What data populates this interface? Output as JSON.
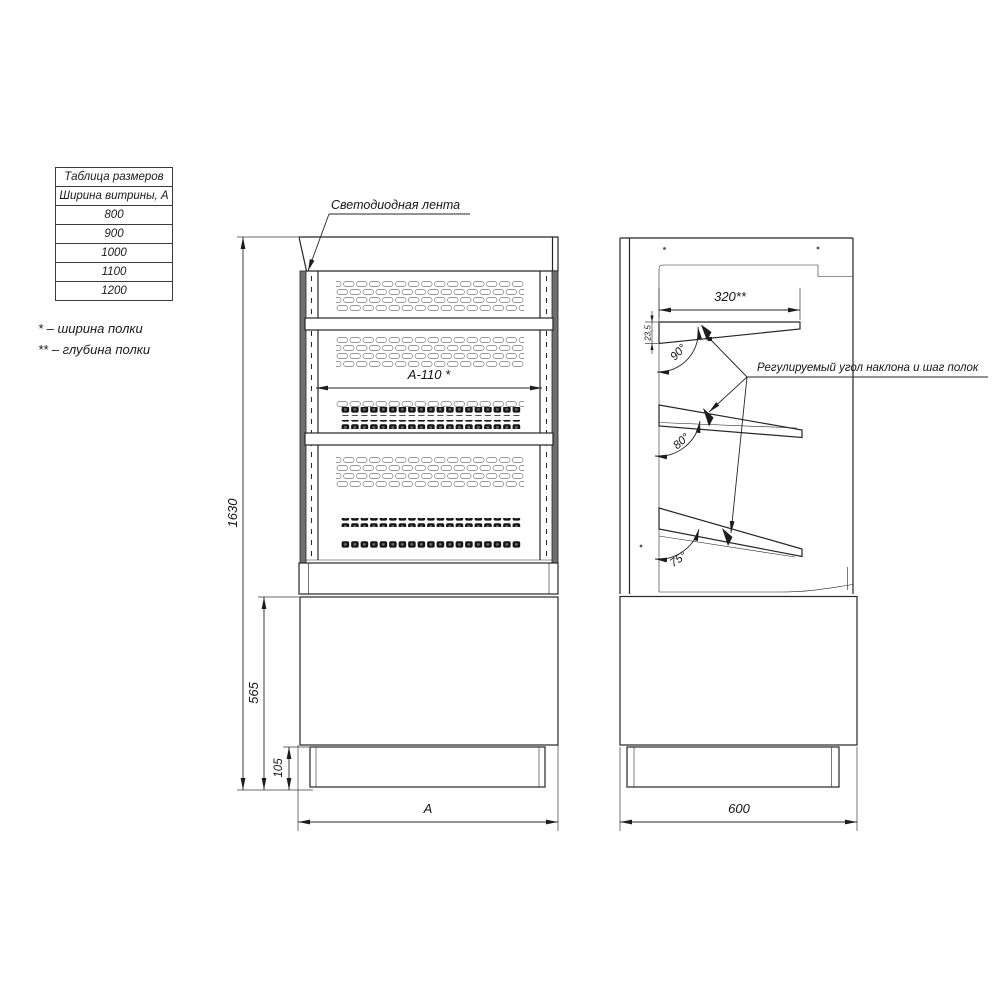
{
  "size_table": {
    "title": "Таблица размеров",
    "subtitle": "Ширина витрины, А",
    "widths": [
      "800",
      "900",
      "1000",
      "1100",
      "1200"
    ]
  },
  "legend": {
    "note_width": "* – ширина полки",
    "note_depth": "** – глубина полки"
  },
  "front_view": {
    "led_label": "Светодиодная лента",
    "dim_total_height": "1630",
    "dim_base_height": "565",
    "dim_plinth_height": "105",
    "dim_width": "А",
    "dim_shelf_width": "А-110 *"
  },
  "side_view": {
    "dim_depth": "600",
    "dim_shelf_depth": "320**",
    "dim_shelf_edge": "23,5",
    "angle_top": "90°",
    "angle_middle": "80°",
    "angle_bottom": "75°",
    "note_adjustable": "Регулируемый угол наклона и шаг полок"
  }
}
